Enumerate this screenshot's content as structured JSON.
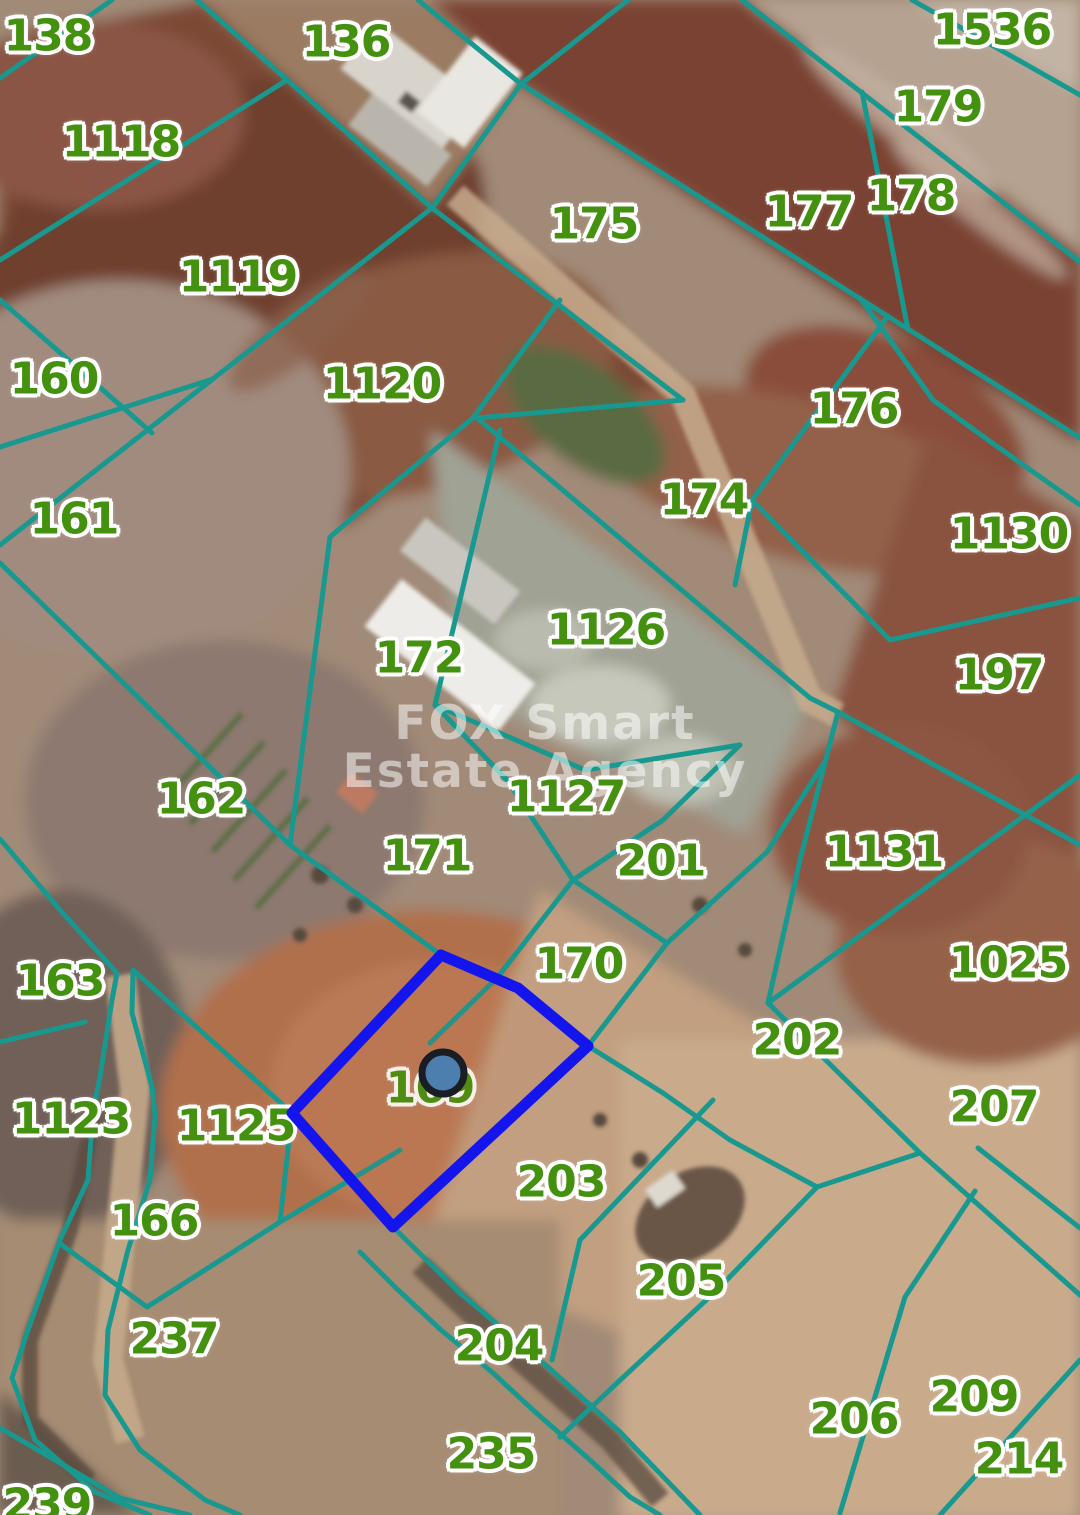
{
  "map": {
    "watermark": {
      "line1": "FOX Smart",
      "line2": "Estate Agency"
    },
    "colors": {
      "boundary": "#18988f",
      "label": "#43910e",
      "highlight": "#1414ed",
      "marker_fill": "#4c7eae",
      "marker_stroke": "#1a1d24",
      "watermark": "rgba(255,255,255,0.52)"
    },
    "highlight": {
      "parcel": "169",
      "points": "441,955 518,988 588,1046 393,1227 292,1113",
      "marker": {
        "x": 443,
        "y": 1073,
        "r": 21
      }
    },
    "parcels": [
      {
        "id": "138",
        "x": 48,
        "y": 36
      },
      {
        "id": "1118",
        "x": 121,
        "y": 142
      },
      {
        "id": "136",
        "x": 346,
        "y": 42
      },
      {
        "id": "1536",
        "x": 992,
        "y": 30
      },
      {
        "id": "179",
        "x": 938,
        "y": 107
      },
      {
        "id": "178",
        "x": 911,
        "y": 196
      },
      {
        "id": "177",
        "x": 809,
        "y": 212
      },
      {
        "id": "175",
        "x": 594,
        "y": 224
      },
      {
        "id": "1119",
        "x": 238,
        "y": 277
      },
      {
        "id": "160",
        "x": 54,
        "y": 379
      },
      {
        "id": "1120",
        "x": 382,
        "y": 384
      },
      {
        "id": "176",
        "x": 854,
        "y": 409
      },
      {
        "id": "161",
        "x": 74,
        "y": 519
      },
      {
        "id": "174",
        "x": 704,
        "y": 500
      },
      {
        "id": "1130",
        "x": 1009,
        "y": 534
      },
      {
        "id": "1126",
        "x": 606,
        "y": 630
      },
      {
        "id": "197",
        "x": 999,
        "y": 675
      },
      {
        "id": "172",
        "x": 419,
        "y": 658
      },
      {
        "id": "162",
        "x": 201,
        "y": 799
      },
      {
        "id": "1127",
        "x": 566,
        "y": 797
      },
      {
        "id": "171",
        "x": 427,
        "y": 856
      },
      {
        "id": "201",
        "x": 661,
        "y": 861
      },
      {
        "id": "1131",
        "x": 884,
        "y": 852
      },
      {
        "id": "163",
        "x": 60,
        "y": 981
      },
      {
        "id": "170",
        "x": 579,
        "y": 964
      },
      {
        "id": "1025",
        "x": 1008,
        "y": 963
      },
      {
        "id": "202",
        "x": 797,
        "y": 1040
      },
      {
        "id": "169",
        "x": 430,
        "y": 1088
      },
      {
        "id": "1123",
        "x": 71,
        "y": 1119
      },
      {
        "id": "1125",
        "x": 236,
        "y": 1126
      },
      {
        "id": "207",
        "x": 994,
        "y": 1107
      },
      {
        "id": "203",
        "x": 561,
        "y": 1182
      },
      {
        "id": "166",
        "x": 154,
        "y": 1221
      },
      {
        "id": "205",
        "x": 681,
        "y": 1281
      },
      {
        "id": "237",
        "x": 174,
        "y": 1339
      },
      {
        "id": "204",
        "x": 499,
        "y": 1346
      },
      {
        "id": "206",
        "x": 854,
        "y": 1419
      },
      {
        "id": "209",
        "x": 974,
        "y": 1397
      },
      {
        "id": "214",
        "x": 1019,
        "y": 1459
      },
      {
        "id": "235",
        "x": 491,
        "y": 1454
      },
      {
        "id": "239",
        "x": 47,
        "y": 1505
      }
    ]
  }
}
